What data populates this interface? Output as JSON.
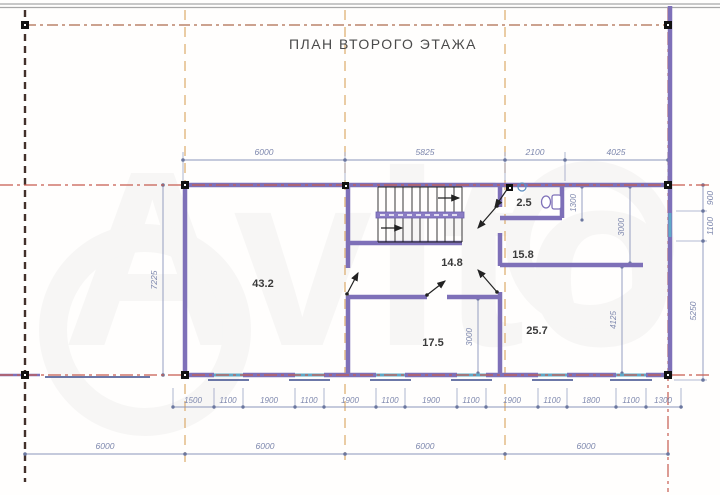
{
  "title": "ПЛАН ВТОРОГО ЭТАЖА",
  "watermark": "Avito",
  "rooms": {
    "living": "43.2",
    "hall": "14.8",
    "wc": "2.5",
    "cabinet": "15.8",
    "room_a": "17.5",
    "room_b": "25.7"
  },
  "dims": {
    "top": [
      "6000",
      "5825",
      "2100",
      "4025"
    ],
    "left": "7225",
    "right": [
      "900",
      "1100",
      "5250"
    ],
    "inner": {
      "wc_depth": "1300",
      "cabinet_depth": "3000",
      "room_b_depth": "4125",
      "room_a_depth": "3000"
    },
    "window_chain": [
      "1500",
      "1100",
      "1900",
      "1100",
      "1900",
      "1100",
      "1900",
      "1100",
      "1900",
      "1100",
      "1800",
      "1100",
      "1300"
    ],
    "overall_bottom": [
      "6000",
      "6000",
      "6000",
      "6000"
    ]
  },
  "colors": {
    "wall": "#7e70b8",
    "window": "#5fa8c7",
    "axis_red": "#c65c50",
    "axis_orange": "#dcaa6a",
    "dimension": "#8b95bb",
    "grid_dark": "#42302a",
    "label_text": "#3a3a3a"
  }
}
